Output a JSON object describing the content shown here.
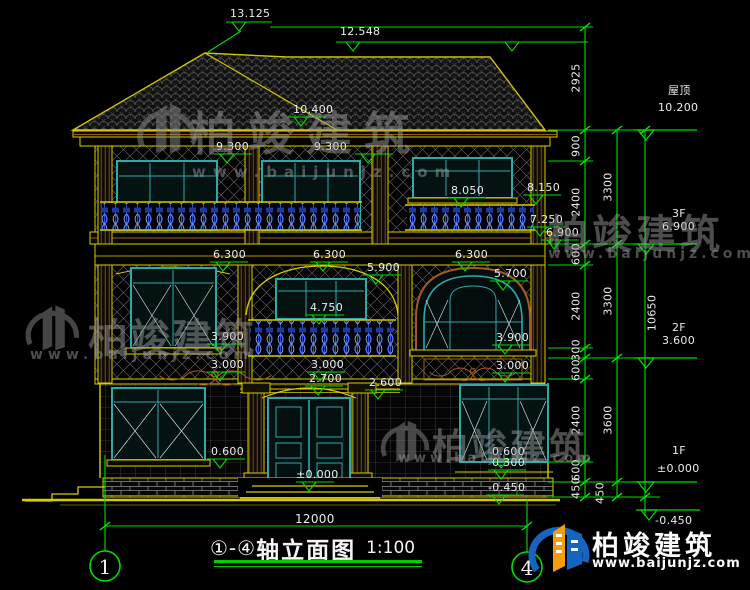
{
  "labels": {
    "ridge_main": "13.125",
    "ridge_side": "12.548",
    "eave": "10.400",
    "win3f_top_a": "9.300",
    "win3f_top_b": "9.300",
    "rail3f": "8.050",
    "sill3f_right": "8.150",
    "cornice_top": "7.250",
    "floor3_edge": "6.900",
    "head2f_a": "6.300",
    "head2f_b": "6.300",
    "head2f_c": "6.300",
    "head2f_mid": "5.900",
    "arch_spring": "5.700",
    "rail2f": "4.750",
    "sill2f_a": "3.900",
    "sill2f_b": "3.900",
    "band1f_a": "3.000",
    "band1f_b": "3.000",
    "band1f_c": "3.000",
    "porch_beam": "2.700",
    "porch_arch": "2.600",
    "door_level": "±0.000",
    "sill1f_left": "0.600",
    "sill1f_right": "0.600",
    "plinth": "0.300",
    "ground_a": "-0.450",
    "ground_b": "-0.450"
  },
  "dims_inner": [
    "2925",
    "900",
    "2400",
    "600",
    "2400",
    "300",
    "600",
    "2400",
    "600",
    "450"
  ],
  "dims_mid": [
    "3300",
    "3300",
    "3600",
    "450"
  ],
  "dims_total": "10650",
  "levels_right": {
    "roof_name": "屋顶",
    "roof_val": "10.200",
    "f3_name": "3F",
    "f3_val": "6.900",
    "f2_name": "2F",
    "f2_val": "3.600",
    "f1_name": "1F",
    "f1_val": "±0.000"
  },
  "bottom": {
    "overall_width": "12000",
    "axis_left": "1",
    "axis_right": "4",
    "title_axes": "①-④",
    "title_text": "轴立面图",
    "title_scale": "1:100"
  },
  "brand": {
    "name": "柏竣建筑",
    "url": "www.baijunjz.com"
  },
  "watermark": {
    "name": "柏竣建筑",
    "url": "www.baijunjz.com"
  },
  "colors": {
    "dim_green": "#00dd00",
    "outline_yellow": "#d8cc00",
    "frame_teal": "#2fa8a8",
    "baluster_blue": "#4a78ff",
    "trim_brown": "#9c5a28",
    "brand_blue": "#1565c0",
    "brand_orange": "#f59e0b"
  }
}
